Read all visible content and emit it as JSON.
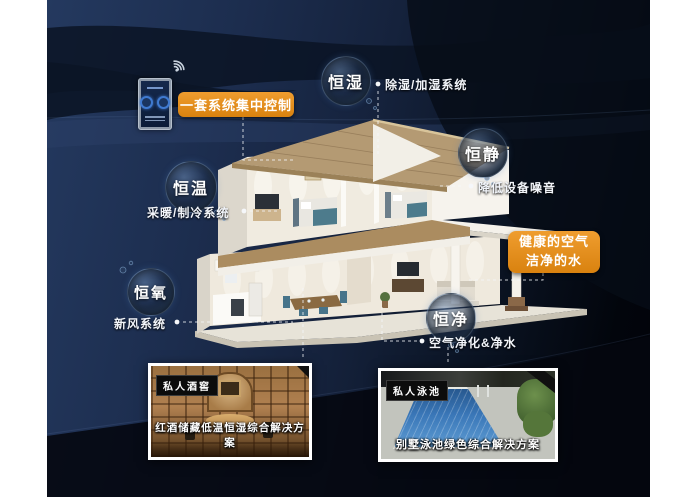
{
  "control_panel": {
    "label": "一套系统集中控制",
    "device": "wall-mounted smart control panel"
  },
  "features": [
    {
      "name": "恒湿",
      "system": "除湿/加湿系统"
    },
    {
      "name": "恒静",
      "system": "降低设备噪音"
    },
    {
      "name": "恒温",
      "system": "采暖/制冷系统"
    },
    {
      "name": "恒氧",
      "system": "新风系统"
    },
    {
      "name": "恒净",
      "system": "空气净化&净水"
    }
  ],
  "highlight": {
    "line1": "健康的空气",
    "line2": "洁净的水"
  },
  "cards": [
    {
      "tag": "私人酒窖",
      "caption": "红酒储藏低温恒湿综合解决方案"
    },
    {
      "tag": "私人泳池",
      "caption": "别墅泳池绿色综合解决方案"
    }
  ],
  "icons": {
    "wifi": "wifi-icon"
  },
  "colors": {
    "accent_orange": "#e0861f",
    "background_navy": "#1a2a47",
    "label_text": "#f2f5fa",
    "card_border": "#ffffff"
  }
}
